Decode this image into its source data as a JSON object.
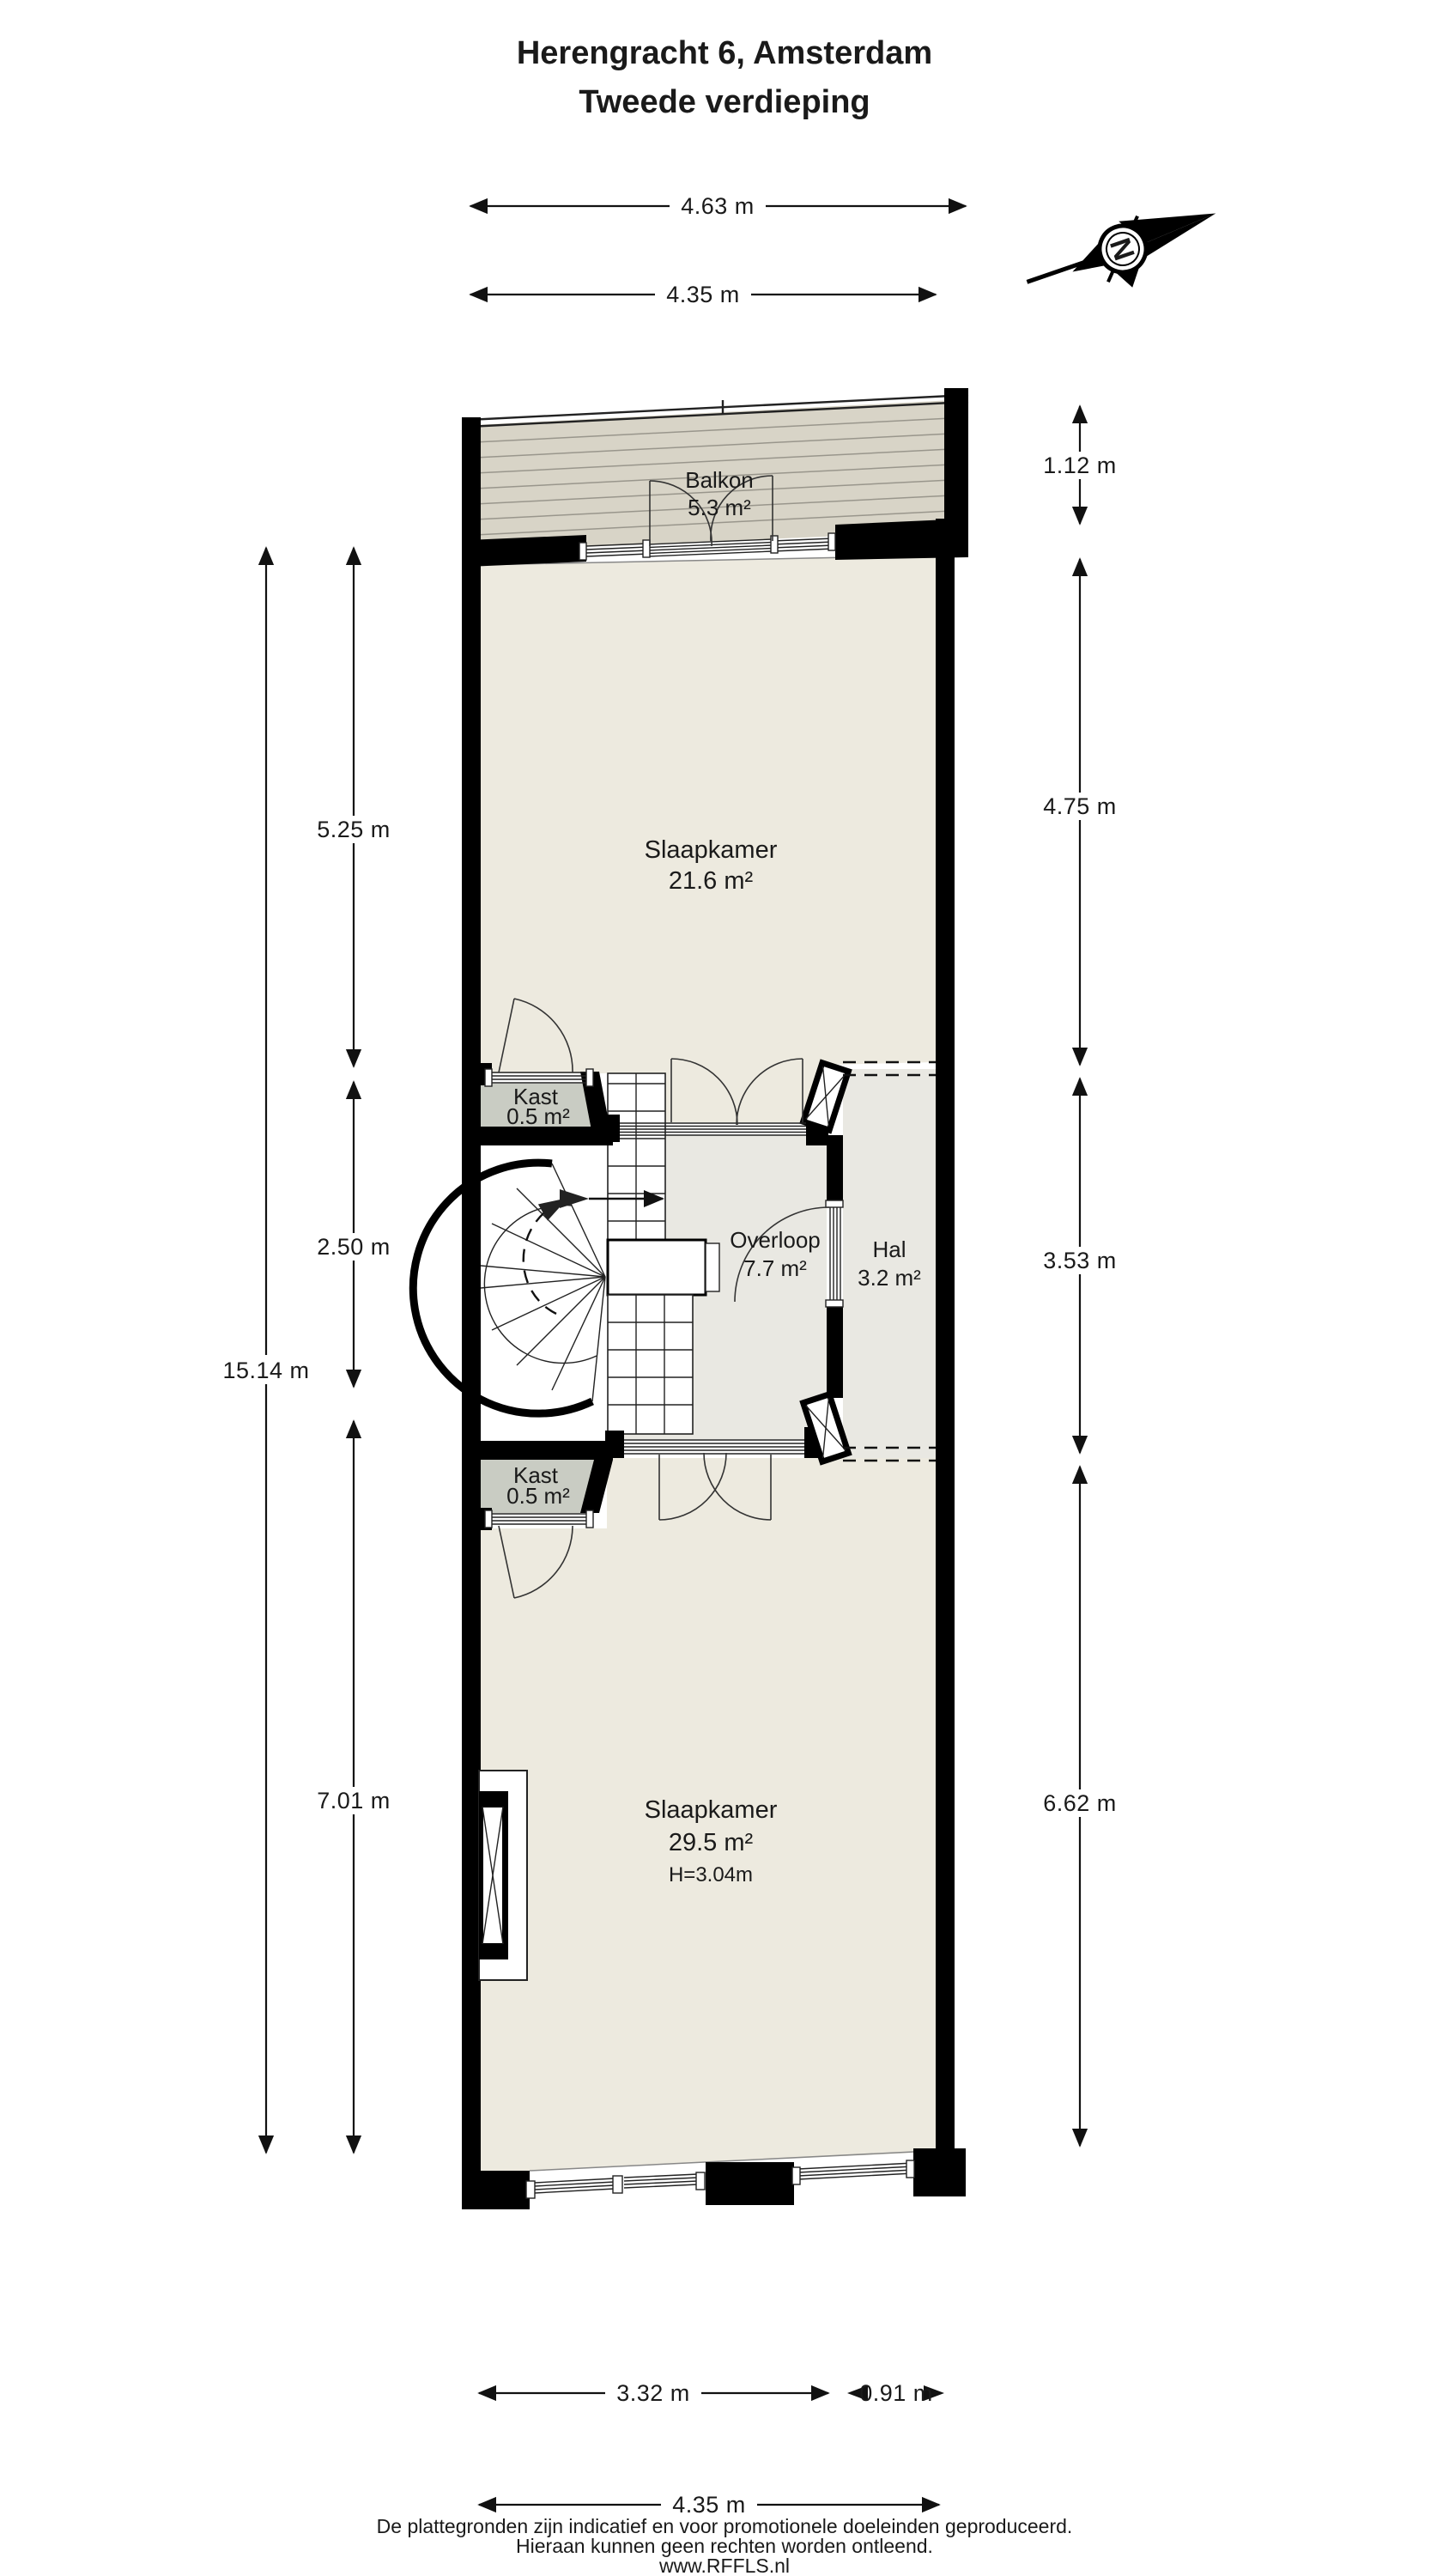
{
  "title": {
    "line1": "Herengracht 6, Amsterdam",
    "line2": "Tweede verdieping"
  },
  "compass": {
    "label": "N"
  },
  "rooms": {
    "balkon": {
      "name": "Balkon",
      "area": "5.3 m²"
    },
    "slaapkamer1": {
      "name": "Slaapkamer",
      "area": "21.6 m²"
    },
    "kast1": {
      "name": "Kast",
      "area": "0.5 m²"
    },
    "overloop": {
      "name": "Overloop",
      "area": "7.7 m²"
    },
    "hal": {
      "name": "Hal",
      "area": "3.2 m²"
    },
    "kast2": {
      "name": "Kast",
      "area": "0.5 m²"
    },
    "slaapkamer2": {
      "name": "Slaapkamer",
      "area": "29.5 m²",
      "height": "H=3.04m"
    }
  },
  "dimensions": {
    "top_outer": "4.63 m",
    "top_inner": "4.35 m",
    "left_total": "15.14 m",
    "left_upper": "5.25 m",
    "left_middle": "2.50 m",
    "left_lower": "7.01 m",
    "right_balcony": "1.12 m",
    "right_upper": "4.75 m",
    "right_middle": "3.53 m",
    "right_lower": "6.62 m",
    "bottom_left": "3.32 m",
    "bottom_right": "0.91 m",
    "bottom_total": "4.35 m"
  },
  "footer": {
    "line1": "De plattegronden zijn indicatief en voor promotionele doeleinden geproduceerd.",
    "line2": "Hieraan kunnen geen rechten worden ontleend.",
    "line3": "www.RFFLS.nl"
  },
  "colors": {
    "wall": "#000000",
    "floor": "#EDEADF",
    "floor_hall": "#E9E8E2",
    "balcony": "#D8D4C7",
    "closet": "#C9CCC3",
    "line": "#111111"
  }
}
